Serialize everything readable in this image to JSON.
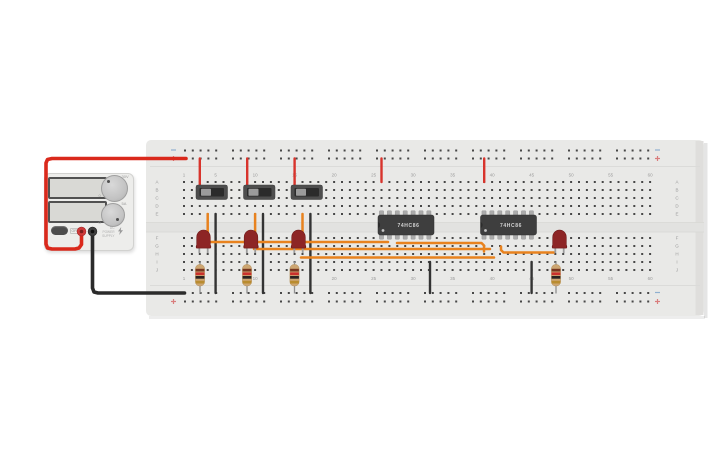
{
  "canvas": {
    "bg": "#ffffff",
    "width": 725,
    "height": 453
  },
  "power_supply": {
    "displays": [
      {
        "value": ""
      },
      {
        "value": ""
      }
    ],
    "knobs": [
      {
        "name": "voltage",
        "labels": [
          {
            "t": "0"
          },
          {
            "t": "30V"
          }
        ]
      },
      {
        "name": "current",
        "labels": [
          {
            "t": "0"
          },
          {
            "t": "5A"
          }
        ]
      }
    ],
    "power_button": {
      "label": "OFF"
    },
    "brand_lines": [
      "DC POWER",
      "SUPPLY"
    ],
    "terminals": [
      {
        "polarity": "positive",
        "color": "#cf3a3a"
      },
      {
        "polarity": "negative",
        "color": "#3f3f3f"
      }
    ]
  },
  "breadboard": {
    "x": 146,
    "y": 140,
    "w": 558,
    "h": 176,
    "color": "#e9e9e7",
    "col_start_x": 184,
    "col_pitch": 7.9,
    "cols": 60,
    "rows_top": {
      "letters": [
        "A",
        "B",
        "C",
        "D",
        "E"
      ],
      "y": [
        182,
        190,
        198,
        206,
        214
      ]
    },
    "rows_bottom": {
      "letters": [
        "F",
        "G",
        "H",
        "I",
        "J"
      ],
      "y": [
        238,
        246,
        254,
        262,
        270
      ]
    },
    "number_labels": [
      1,
      5,
      10,
      15,
      20,
      25,
      30,
      35,
      40,
      45,
      50,
      55,
      60
    ],
    "top_label_y": 176.5,
    "bottom_label_y": 280,
    "letter_x": [
      157,
      677
    ],
    "rails": {
      "rows_y": [
        150.5,
        158.5,
        293,
        301.5
      ],
      "group_start_x": 185,
      "groups": 10,
      "group_pitch": 48,
      "pin_pitch": 7.8,
      "pins_per_group": 5,
      "minus_color": "#8fb0d0",
      "plus_color": "#d97d7d",
      "mark_x": [
        173.5,
        657.5
      ]
    },
    "pin_color": "#474747",
    "label_color": "#9b9b9b"
  },
  "components": {
    "switches": [
      {
        "x": 196,
        "y": 185
      },
      {
        "x": 243.5,
        "y": 185
      },
      {
        "x": 291,
        "y": 185
      }
    ],
    "ics": [
      {
        "x": 378,
        "y": 215,
        "w": 56,
        "h": 20,
        "label": "74HC86",
        "pin_start_x": 381.5
      },
      {
        "x": 480.5,
        "y": 215,
        "w": 56,
        "h": 20,
        "label": "74HC86",
        "pin_start_x": 484
      }
    ],
    "ic_pin_pitch": 7.9,
    "ic_pins_per_side": 7,
    "leds": [
      {
        "cx": 203.5,
        "y": 230
      },
      {
        "cx": 251,
        "y": 230
      },
      {
        "cx": 298.5,
        "y": 230
      },
      {
        "cx": 559.5,
        "y": 230
      }
    ],
    "led_color": "#8d2525",
    "resistors": [
      {
        "cx": 200
      },
      {
        "cx": 247
      },
      {
        "cx": 294.5
      },
      {
        "cx": 556
      }
    ],
    "resistor_body_y": 264.5,
    "resistor_bands": [
      "#77351f",
      "#c9302c",
      "#2a2321",
      "#b98c2f"
    ]
  },
  "wires": {
    "orange_color": "#e8821e",
    "red_color": "#d8342c",
    "black_color": "#333333",
    "red_cable": {
      "color": "#da291c",
      "path": [
        [
          81.5,
          233
        ],
        [
          81.5,
          244.5
        ],
        [
          79,
          248
        ],
        [
          75,
          249
        ],
        [
          52,
          249
        ],
        [
          47.5,
          248
        ],
        [
          46,
          244
        ],
        [
          46,
          163
        ],
        [
          47.5,
          159.5
        ],
        [
          52,
          158.5
        ],
        [
          186,
          158.5
        ]
      ]
    },
    "black_cable": {
      "color": "#2b2b2b",
      "path": [
        [
          92.5,
          233
        ],
        [
          92.5,
          288
        ],
        [
          94,
          292
        ],
        [
          98,
          293
        ],
        [
          184.5,
          293
        ]
      ]
    },
    "red_jumpers": [
      {
        "x": 199.8,
        "y1": 158.5,
        "y2": 190
      },
      {
        "x": 247.2,
        "y1": 158.5,
        "y2": 190
      },
      {
        "x": 294.6,
        "y1": 158.5,
        "y2": 190
      },
      {
        "x": 381.5,
        "y1": 158.5,
        "y2": 182
      },
      {
        "x": 484.2,
        "y1": 158.5,
        "y2": 182
      }
    ],
    "black_jumpers": [
      {
        "x": 215.6,
        "y1": 214,
        "y2": 293
      },
      {
        "x": 263,
        "y1": 214,
        "y2": 293
      },
      {
        "x": 310.4,
        "y1": 214,
        "y2": 293
      },
      {
        "x": 430,
        "y1": 262,
        "y2": 293
      },
      {
        "x": 531.6,
        "y1": 262,
        "y2": 293
      }
    ],
    "orange_verticals": [
      {
        "x": 207.7,
        "y1": 214,
        "y2": 240
      },
      {
        "x": 255.1,
        "y1": 214,
        "y2": 240
      },
      {
        "x": 302.5,
        "y1": 214,
        "y2": 240
      }
    ],
    "orange_paths": [
      [
        [
          209,
          242
        ],
        [
          388,
          242
        ]
      ],
      [
        [
          397,
          243
        ],
        [
          481.5,
          243
        ],
        [
          484,
          245.5
        ],
        [
          484,
          251.5
        ]
      ],
      [
        [
          254,
          249
        ],
        [
          490,
          249
        ]
      ],
      [
        [
          301,
          257.5
        ],
        [
          494,
          257.5
        ]
      ],
      [
        [
          501,
          246.5
        ],
        [
          501,
          250
        ],
        [
          503.5,
          252.5
        ],
        [
          554,
          252.5
        ]
      ]
    ]
  }
}
